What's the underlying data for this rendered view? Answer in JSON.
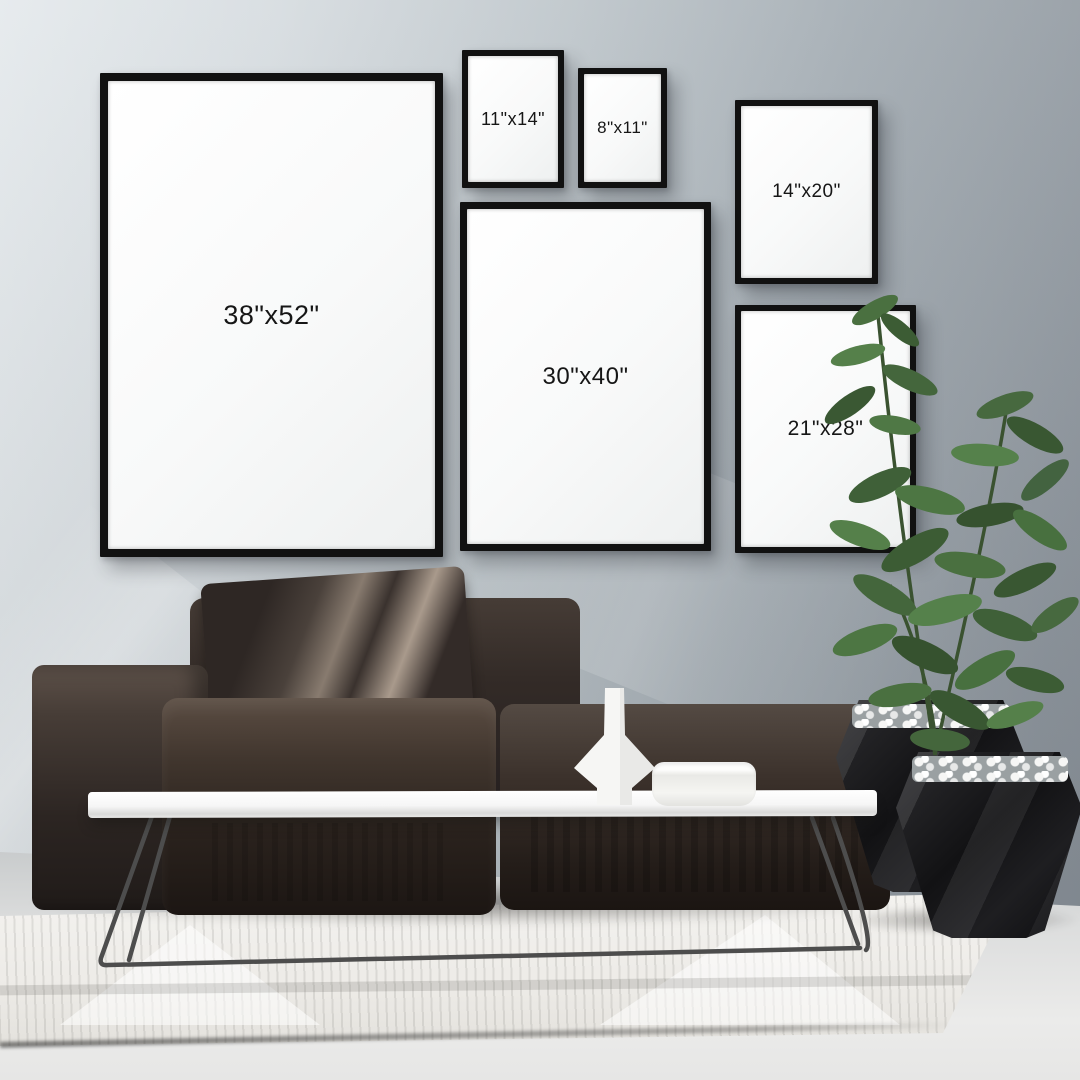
{
  "scene": {
    "frames": [
      {
        "name": "frame-38x52",
        "label": "38\"x52\""
      },
      {
        "name": "frame-11x14",
        "label": "11\"x14\""
      },
      {
        "name": "frame-8x11",
        "label": "8\"x11\""
      },
      {
        "name": "frame-14x20",
        "label": "14\"x20\""
      },
      {
        "name": "frame-30x40",
        "label": "30\"x40\""
      },
      {
        "name": "frame-21x28",
        "label": "21\"x28\""
      }
    ],
    "objects": [
      "sofa",
      "pillow",
      "coffee-table",
      "vase",
      "bowl",
      "plant",
      "planters",
      "rug",
      "picture-frames"
    ],
    "colors": {
      "wall_light": "#e4e9ec",
      "wall_dark": "#878f97",
      "frame_border": "#111111",
      "frame_matte": "#f8f9f9",
      "label_text": "#161616",
      "sofa": "#2a221d",
      "table": "#f6f6f6",
      "plant_green": "#44663c",
      "planter": "#121214",
      "rug": "#f0eeea",
      "floor": "#dcdddd"
    }
  }
}
